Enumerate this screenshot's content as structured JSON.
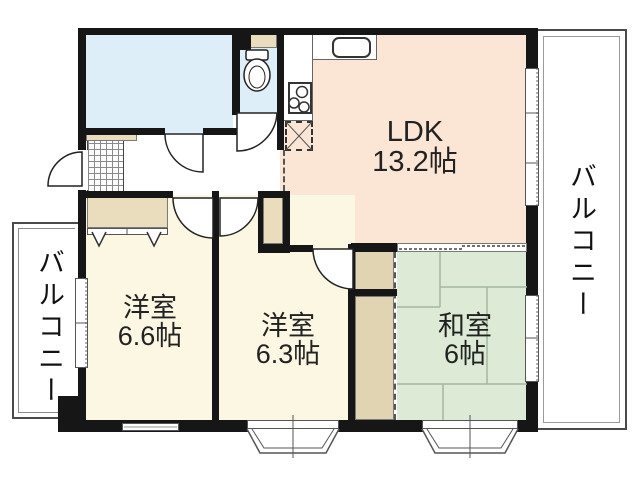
{
  "floorplan": {
    "rooms": {
      "ldk": {
        "name": "LDK",
        "area": "13.2帖"
      },
      "western_room_1": {
        "name": "洋室",
        "area": "6.6帖"
      },
      "western_room_2": {
        "name": "洋室",
        "area": "6.3帖"
      },
      "japanese_room": {
        "name": "和室",
        "area": "6帖"
      },
      "balcony_left": {
        "name": "バルコニー"
      },
      "balcony_right": {
        "name": "バルコニー"
      }
    },
    "icons": {
      "toilet": "toilet-icon",
      "stove": "stove-burners-icon",
      "sink": "kitchen-sink-icon",
      "refrigerator": "refrigerator-dashed-box-icon",
      "entrance": "genkan-tile-grid",
      "closet_hangers": "closet-chevron-marks",
      "doors": "door-swing-arcs",
      "bay_windows": "bay-window-trapezoids"
    },
    "colors": {
      "wall": "#161616",
      "ldk_floor": "#fbe5d5",
      "western_room_floor": "#fbf7e2",
      "tatami_floor": "#dcead6",
      "wet_area_floor": "#ddeef9",
      "closet": "#e9ddbd",
      "tatami_closet": "#e0d4b2",
      "tatami_line": "#a3b89f",
      "outline": "#555555",
      "text": "#222222"
    }
  }
}
